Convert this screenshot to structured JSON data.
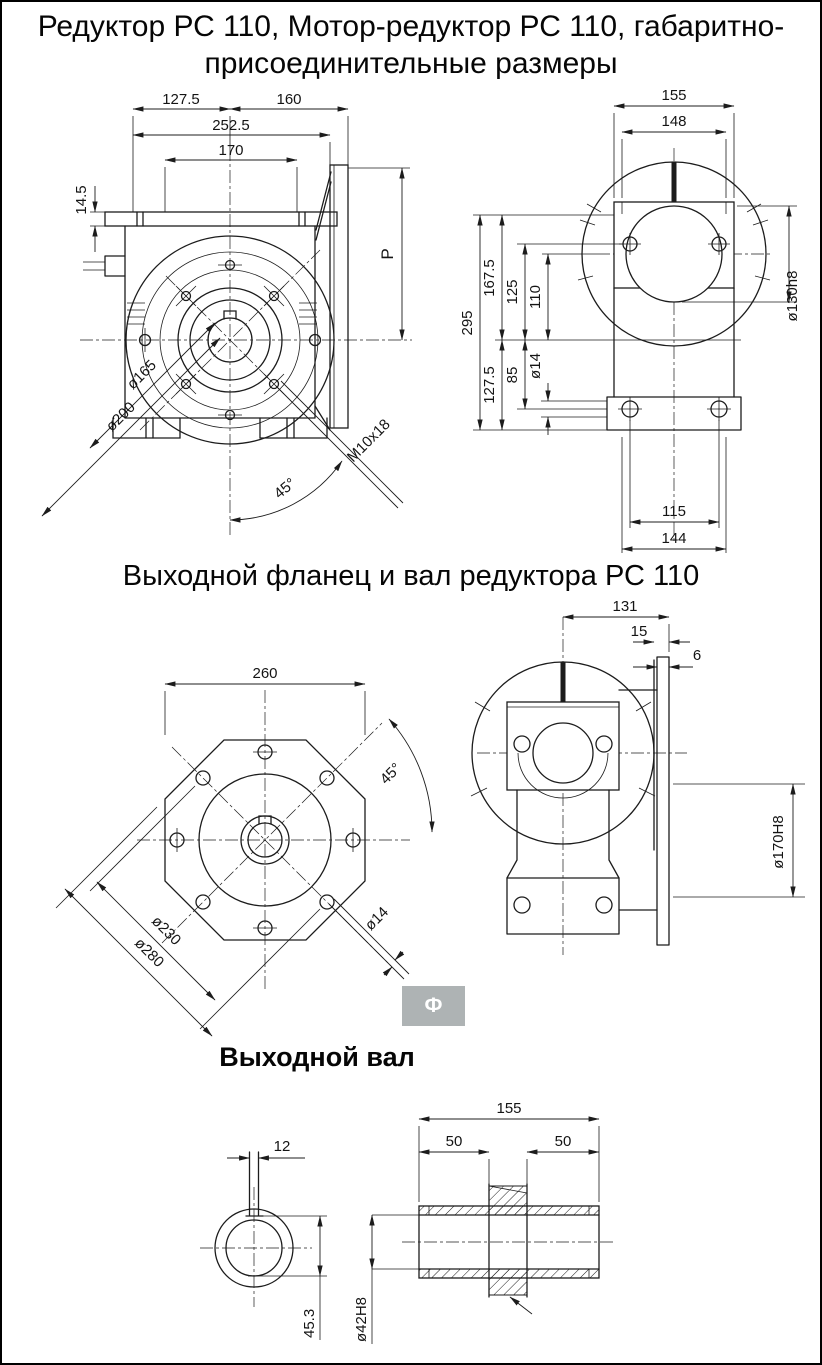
{
  "header": {
    "title_line1": "Редуктор РС 110, Мотор-редуктор РС 110, габаритно-",
    "title_line2": "присоединительные размеры"
  },
  "sections": {
    "flange_title": "Выходной фланец и вал редуктора РС 110",
    "shaft_title": "Выходной вал"
  },
  "badge": {
    "label": "Ф"
  },
  "colors": {
    "background": "#ffffff",
    "drawing_line": "#1c1c1c",
    "badge_bg": "#aeb3b4",
    "badge_text": "#ffffff"
  },
  "front_view": {
    "w127_5": "127.5",
    "w160": "160",
    "w252_5": "252.5",
    "w170": "170",
    "h14_5": "14.5",
    "p": "P",
    "d165": "ø165",
    "d200": "ø200",
    "thread": "M10x18",
    "angle": "45°"
  },
  "side_view": {
    "w155": "155",
    "w148": "148",
    "h295": "295",
    "h167_5": "167.5",
    "h125": "125",
    "h110": "110",
    "h127_5": "127.5",
    "h85": "85",
    "d14": "ø14",
    "d130": "ø130h8",
    "w115": "115",
    "w144": "144"
  },
  "flange_view": {
    "w260": "260",
    "angle": "45°",
    "d230": "ø230",
    "d280": "ø280",
    "d14": "ø14"
  },
  "flange_side_view": {
    "w131": "131",
    "w15": "15",
    "w6": "6",
    "d170": "ø170H8"
  },
  "shaft_end_view": {
    "w12": "12",
    "h45_3": "45.3"
  },
  "shaft_section_view": {
    "w155": "155",
    "w50_left": "50",
    "w50_right": "50",
    "d42": "ø42H8"
  }
}
